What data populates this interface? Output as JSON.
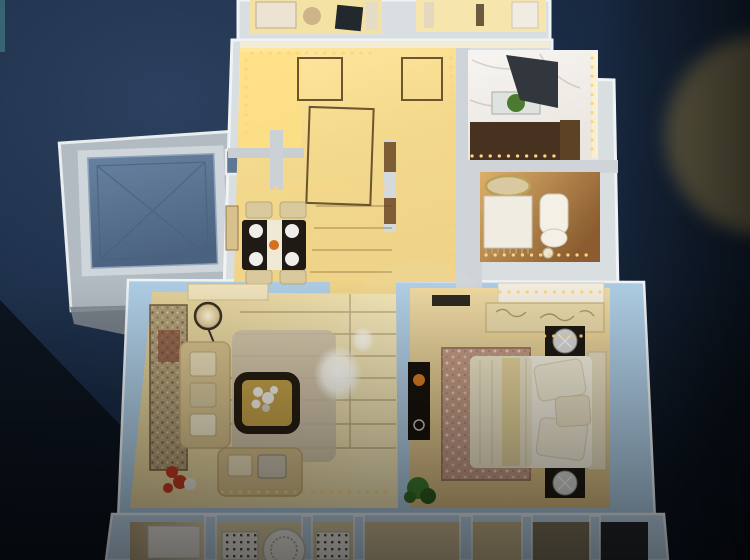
{
  "meta": {
    "title": "apartment-scale-model-photo",
    "style": "top-down photograph of an illuminated miniature apartment model on a dark navy showroom backdrop"
  },
  "palette": {
    "bg_teal": "#3f7079",
    "glow_olive": "#6f6749",
    "wall_white": "#d9dee1",
    "wall_blue": "#adcce3",
    "wall_blue_light": "#bfd8ec",
    "wall_gray": "#b2bbc2",
    "wall_gray_dark": "#7f8890",
    "elevator_flat": "#5d7795",
    "counter": "#47321f",
    "hood": "#31373c",
    "sink": "#dfe3df",
    "melon": "#4c7a2f",
    "vanity": "#f1ece2",
    "toilet": "#f4f0e6",
    "mirror_gold": "#b9a15a",
    "table_dark": "#1f1a14",
    "runner": "#f0e9d6",
    "plate": "#efeeea",
    "chair": "#d9c99c",
    "orange": "#d4701f",
    "sofa": "#d8c28d",
    "shag": "#cfc2aa",
    "tapestry": "#b09d76",
    "coffee_top": "#c5a24a",
    "coffee_frame": "#261e12",
    "flower_white": "#f4f1ea",
    "flower_red": "#c43b23",
    "bed": "#f6f1e2",
    "bed_runner": "#e3d194",
    "headboard": "#e8dec0",
    "wardrobe": "#e9d8a9",
    "wardrobe_top": "#f3eee0",
    "nightstand": "#1f1912",
    "lamp_silver": "#d6d6d4",
    "tv": "#17120c",
    "bed_rug": "#c49b85",
    "plant": "#3f7d2c",
    "screen_white": "#f1efe7",
    "pane_dark": "#23262b",
    "pane_tan": "#c9b68c",
    "led": "#ffd47d",
    "seam": "#5d4426",
    "door_outline": "#4a3418"
  },
  "scene": {
    "backdrop": "dark navy studio wall with blurred olive spotlight glow at right edge",
    "model": {
      "annex": "elevator shaft marked with X cross, slate blue",
      "rooms": [
        "partial top room with desk",
        "partial top room with white fixtures",
        "entry hall with open door outlines and LED strips",
        "kitchen with marble floor, dark range hood, counter, sink and melon",
        "bathroom with vanity, gold mirror, toilet and floor drain",
        "dining area with dark table, white runner, four plates, four chairs",
        "living room with two sofas, coffee table with white flowers, floor lamp, tapestry rug, shag rug, red flowers",
        "bedroom with double bed, wardrobe, two nightstands with silver lamps, TV console, patterned rug, green plant",
        "balcony band with white decor screens, medallion and window panes"
      ],
      "lighting": "warm amber LED dot strips along interior walls, white glare reflections on glass cover"
    }
  }
}
